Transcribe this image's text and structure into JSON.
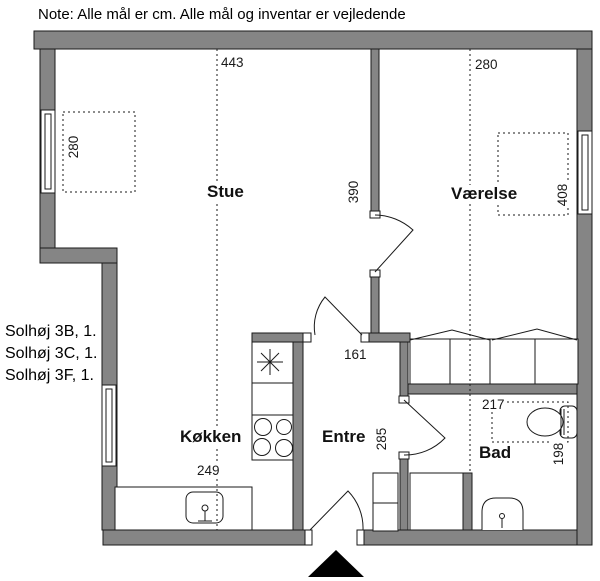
{
  "note": "Note: Alle mål er cm. Alle mål og inventar er vejledende",
  "address": [
    "Solhøj 3B, 1.",
    "Solhøj 3C, 1.",
    "Solhøj 3F, 1."
  ],
  "rooms": {
    "stue": "Stue",
    "vaerelse": "Værelse",
    "koekken": "Køkken",
    "entre": "Entre",
    "bad": "Bad"
  },
  "dims": {
    "stue_width": "443",
    "vaerelse_width": "280",
    "stue_furniture": "280",
    "stue_length": "390",
    "entre_width": "161",
    "entre_depth": "285",
    "koekken_width": "249",
    "bad_width": "217",
    "bad_depth": "198",
    "bed_length": "408"
  },
  "colors": {
    "wall_fill": "#858585",
    "outline": "#1a1a1a",
    "background": "#ffffff"
  }
}
